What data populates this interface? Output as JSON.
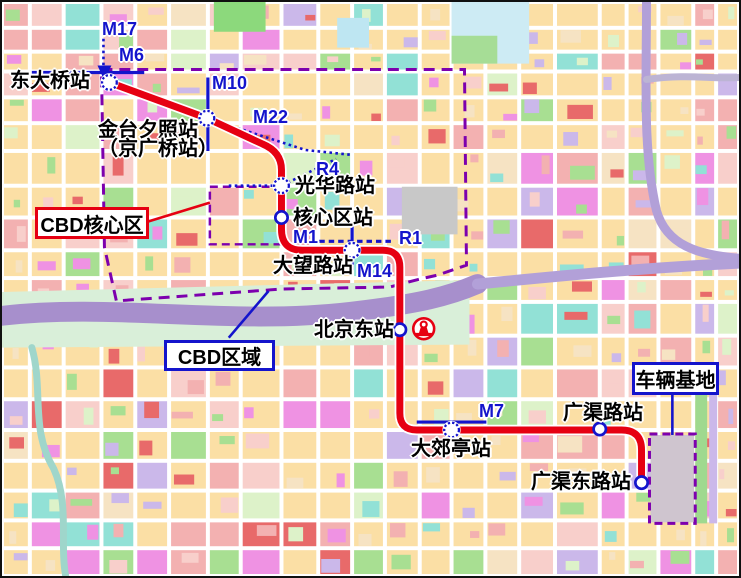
{
  "colors": {
    "line_red": "#E60012",
    "metro_blue": "#1414CC",
    "boundary_purple": "#7D00AE",
    "label_black": "#000000",
    "halo_white": "#FFFFFF",
    "map_road_white": "#FFFFFF",
    "map_palette": [
      "#FBDFA5",
      "#F3B1B1",
      "#F8CFCB",
      "#A8DF92",
      "#92E1D6",
      "#EF92E3",
      "#E86A6A",
      "#CBB8EA",
      "#DDF2C9",
      "#F6E3C3"
    ]
  },
  "stations": [
    {
      "name": "东大桥站",
      "x": 108,
      "y": 81,
      "interchange": true,
      "label": {
        "x": 8,
        "y": 70,
        "lines": [
          "东大桥站"
        ]
      }
    },
    {
      "name": "金台夕照站（京广桥站）",
      "x": 206,
      "y": 117,
      "interchange": true,
      "label": {
        "x": 96,
        "y": 119,
        "lines": [
          "金台夕照站",
          "（京广桥站）"
        ]
      }
    },
    {
      "name": "光华路站",
      "x": 281,
      "y": 185,
      "interchange": true,
      "label": {
        "x": 293,
        "y": 175,
        "lines": [
          "光华路站"
        ]
      }
    },
    {
      "name": "核心区站",
      "x": 281,
      "y": 217,
      "interchange": false,
      "label": {
        "x": 291,
        "y": 207,
        "lines": [
          "核心区站"
        ]
      }
    },
    {
      "name": "大望路站",
      "x": 352,
      "y": 250,
      "interchange": true,
      "label": {
        "x": 271,
        "y": 255,
        "lines": [
          "大望路站"
        ]
      }
    },
    {
      "name": "北京东站",
      "x": 400,
      "y": 330,
      "interchange": false,
      "label": {
        "x": 312,
        "y": 319,
        "lines": [
          "北京东站"
        ]
      }
    },
    {
      "name": "大郊亭站",
      "x": 452,
      "y": 431,
      "interchange": true,
      "label": {
        "x": 409,
        "y": 438,
        "lines": [
          "大郊亭站"
        ]
      }
    },
    {
      "name": "广渠路站",
      "x": 601,
      "y": 430,
      "interchange": false,
      "label": {
        "x": 561,
        "y": 402,
        "lines": [
          "广渠路站"
        ]
      }
    },
    {
      "name": "广渠东路站",
      "x": 643,
      "y": 484,
      "interchange": false,
      "label": {
        "x": 529,
        "y": 471,
        "lines": [
          "广渠东路站"
        ]
      }
    }
  ],
  "red_line": {
    "path": "M108,81 L206,117 L262,143 Q281,151 281,169 L281,229 Q281,250 302,250 L383,250 Q400,250 400,267 L400,414 Q400,431 417,431 L623,431 Q643,431 643,451 L643,484"
  },
  "connectors": [
    {
      "id": "M17",
      "style": "dotted",
      "points": "102,37 102,78",
      "label": {
        "text": "M17",
        "x": 100,
        "y": 17
      }
    },
    {
      "id": "M6",
      "style": "solid",
      "points": "30,71 143,71",
      "label": {
        "text": "M6",
        "x": 117,
        "y": 43
      }
    },
    {
      "id": "M10",
      "style": "solid",
      "points": "207,76 207,150",
      "label": {
        "text": "M10",
        "x": 210,
        "y": 71
      }
    },
    {
      "id": "M22",
      "style": "dotted",
      "points": "112,84 206,117 305,149 352,154",
      "label": {
        "text": "M22",
        "x": 251,
        "y": 105
      }
    },
    {
      "id": "R4",
      "style": "dotted",
      "points": "228,185 281,185 336,158",
      "label": {
        "text": "R4",
        "x": 314,
        "y": 157
      }
    },
    {
      "id": "M1",
      "style": "none",
      "points": "",
      "label": {
        "text": "M1",
        "x": 291,
        "y": 225
      }
    },
    {
      "id": "R1",
      "style": "dashed",
      "points": "319,241 393,241",
      "label": {
        "text": "R1",
        "x": 397,
        "y": 226
      }
    },
    {
      "id": "M14",
      "style": "solid",
      "points": "352,226 352,270",
      "label": {
        "text": "M14",
        "x": 355,
        "y": 259
      }
    },
    {
      "id": "M7",
      "style": "solid",
      "points": "417,423 487,423",
      "label": {
        "text": "M7",
        "x": 477,
        "y": 399
      }
    }
  ],
  "boundaries": [
    {
      "id": "cbd-area",
      "path": "M100,68 L465,68 L467,265 L438,275 L420,279 L390,287 L282,289 L115,301 L103,247 Z",
      "dash": "11 7",
      "width": 3
    },
    {
      "id": "cbd-core",
      "path": "M209,186 L281,186 L281,244 L209,244 Z",
      "dash": "8 5",
      "width": 2.5
    },
    {
      "id": "depot",
      "path": "M651,435 L697,435 L697,525 L651,525 Z",
      "dash": "8 5",
      "width": 3
    }
  ],
  "callout_boxes": [
    {
      "id": "cbd-core-box",
      "text": "CBD核心区",
      "x": 33,
      "y": 205,
      "w": 114,
      "h": 32,
      "border": "#E60012",
      "line": "147,221 209,202"
    },
    {
      "id": "cbd-area-box",
      "text": "CBD区域",
      "x": 162,
      "y": 338,
      "w": 111,
      "h": 31,
      "border": "#1414CC",
      "line": "228,338 268,291"
    },
    {
      "id": "depot-box",
      "text": "车辆基地",
      "x": 630,
      "y": 360,
      "w": 87,
      "h": 33,
      "border": "#1414CC",
      "line": "674,393 674,436"
    }
  ],
  "railway_station_icon": {
    "x": 424,
    "y": 329
  },
  "map_background": {
    "features": [
      {
        "d": "M213,0 h52 v30 h-52 Z",
        "fill": "#8CD97C"
      },
      {
        "d": "M337,16 h32 v30 h-32 Z",
        "fill": "#BEE6F2"
      },
      {
        "d": "M452,0 h78 v62 h-78 Z",
        "fill": "#CDEBF4"
      },
      {
        "d": "M452,34 h46 v28 h-46 Z",
        "fill": "#A6DD96"
      },
      {
        "d": "M402,186 h56 v48 h-56 Z",
        "fill": "#C8C8C8"
      },
      {
        "d": "M0,292 L470,280 L470,345 L0,348 Z",
        "fill": "#D9EFD9"
      },
      {
        "d": "M0,316 C110,303 230,326 350,312 C420,304 450,296 478,284",
        "stroke": "#A78FCC",
        "w": 20
      },
      {
        "d": "M478,284 C560,276 640,268 741,263",
        "stroke": "#B2A0D8",
        "w": 11
      },
      {
        "d": "M648,0 C648,80 644,150 658,210 C668,245 700,255 741,258",
        "stroke": "#B2A0D8",
        "w": 9
      },
      {
        "d": "M648,78 C690,72 715,78 741,76",
        "stroke": "#BCB4D4",
        "w": 7
      },
      {
        "d": "M30,348 C42,390 28,430 52,470 C68,505 58,545 64,578",
        "stroke": "#9FD6CB",
        "w": 7
      },
      {
        "d": "M697,393 h12 v132 h-12 Z",
        "fill": "#9FD98F"
      },
      {
        "d": "M711,393 h8 v132 h-8 Z",
        "fill": "#CBB8EA"
      },
      {
        "d": "M652,436 h44 v88 h-44 Z",
        "fill": "#CFC5CF"
      }
    ]
  }
}
